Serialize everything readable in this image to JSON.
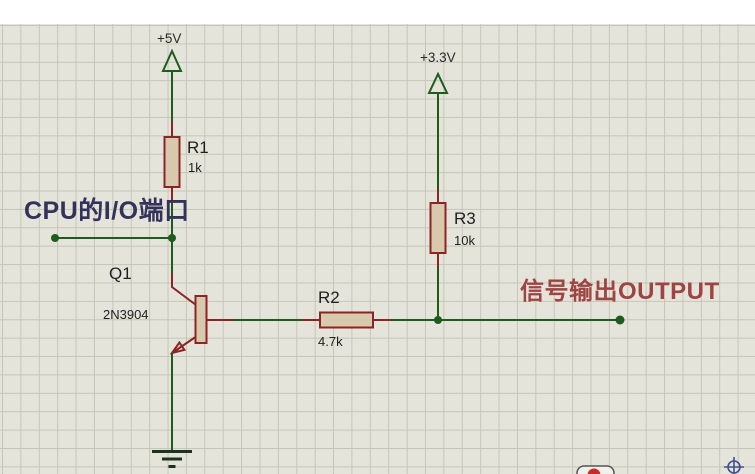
{
  "schematic": {
    "colors": {
      "background": "#ffffff",
      "sheet": "#e5e4da",
      "grid_line": "#c5c6b8",
      "wire": "#1d5c1d",
      "pin": "#8b2525",
      "body_fill": "#d9c9ac",
      "body_outline": "#8b2525",
      "label_text": "#1f1f1f",
      "input_label": "#32325a",
      "output_label": "#a04343",
      "ground": "#1e331e",
      "origin_marker": "#3f518c",
      "watermark_red": "#cc2a2a"
    },
    "power_terminals": [
      {
        "label": "+5V"
      },
      {
        "label": "+3.3V"
      }
    ],
    "components": [
      {
        "ref": "R1",
        "value": "1k",
        "type": "resistor"
      },
      {
        "ref": "R2",
        "value": "4.7k",
        "type": "resistor"
      },
      {
        "ref": "R3",
        "value": "10k",
        "type": "resistor"
      },
      {
        "ref": "Q1",
        "value": "2N3904",
        "type": "npn-transistor"
      }
    ],
    "annotations": [
      {
        "text": "CPU的I/O端口"
      },
      {
        "text": "信号输出OUTPUT"
      }
    ]
  }
}
